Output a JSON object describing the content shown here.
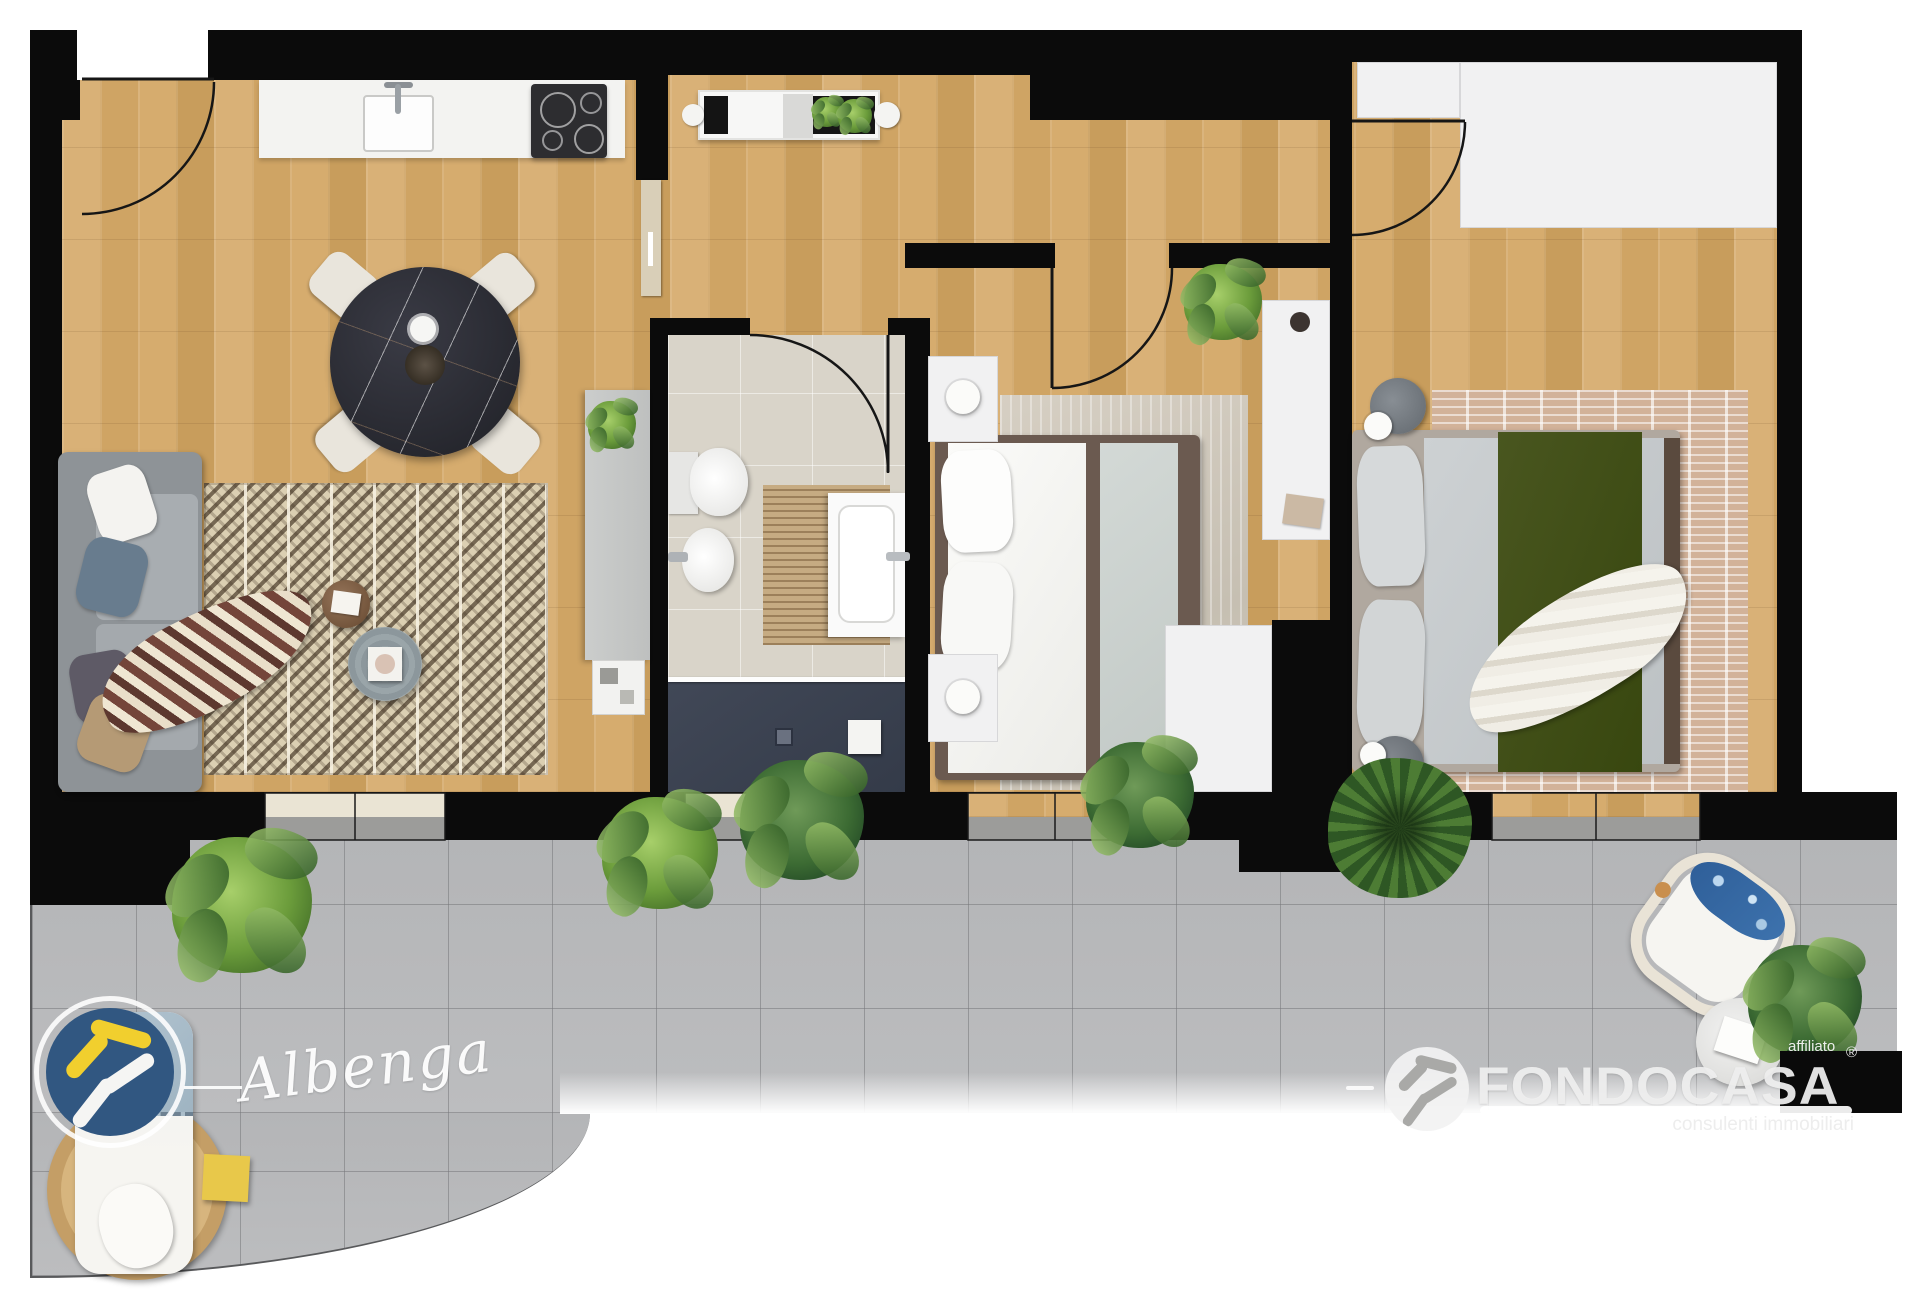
{
  "watermarks": {
    "office_label": "Albenga",
    "brand": "FONDOCASA",
    "brand_tagline": "consulenti immobiliari",
    "brand_affiliate_label": "affiliato",
    "registered_symbol": "®"
  },
  "palette": {
    "wall_black": "#0b0b0b",
    "wood_floor": "#d2a96b",
    "bathroom_tile": "#d9d4c9",
    "shower_tray": "#3a4150",
    "terrace_tile": "#babbbd",
    "brand_blue": "#315781",
    "brand_yellow": "#f1cf2e",
    "logo_white": "#f2f2f2"
  }
}
